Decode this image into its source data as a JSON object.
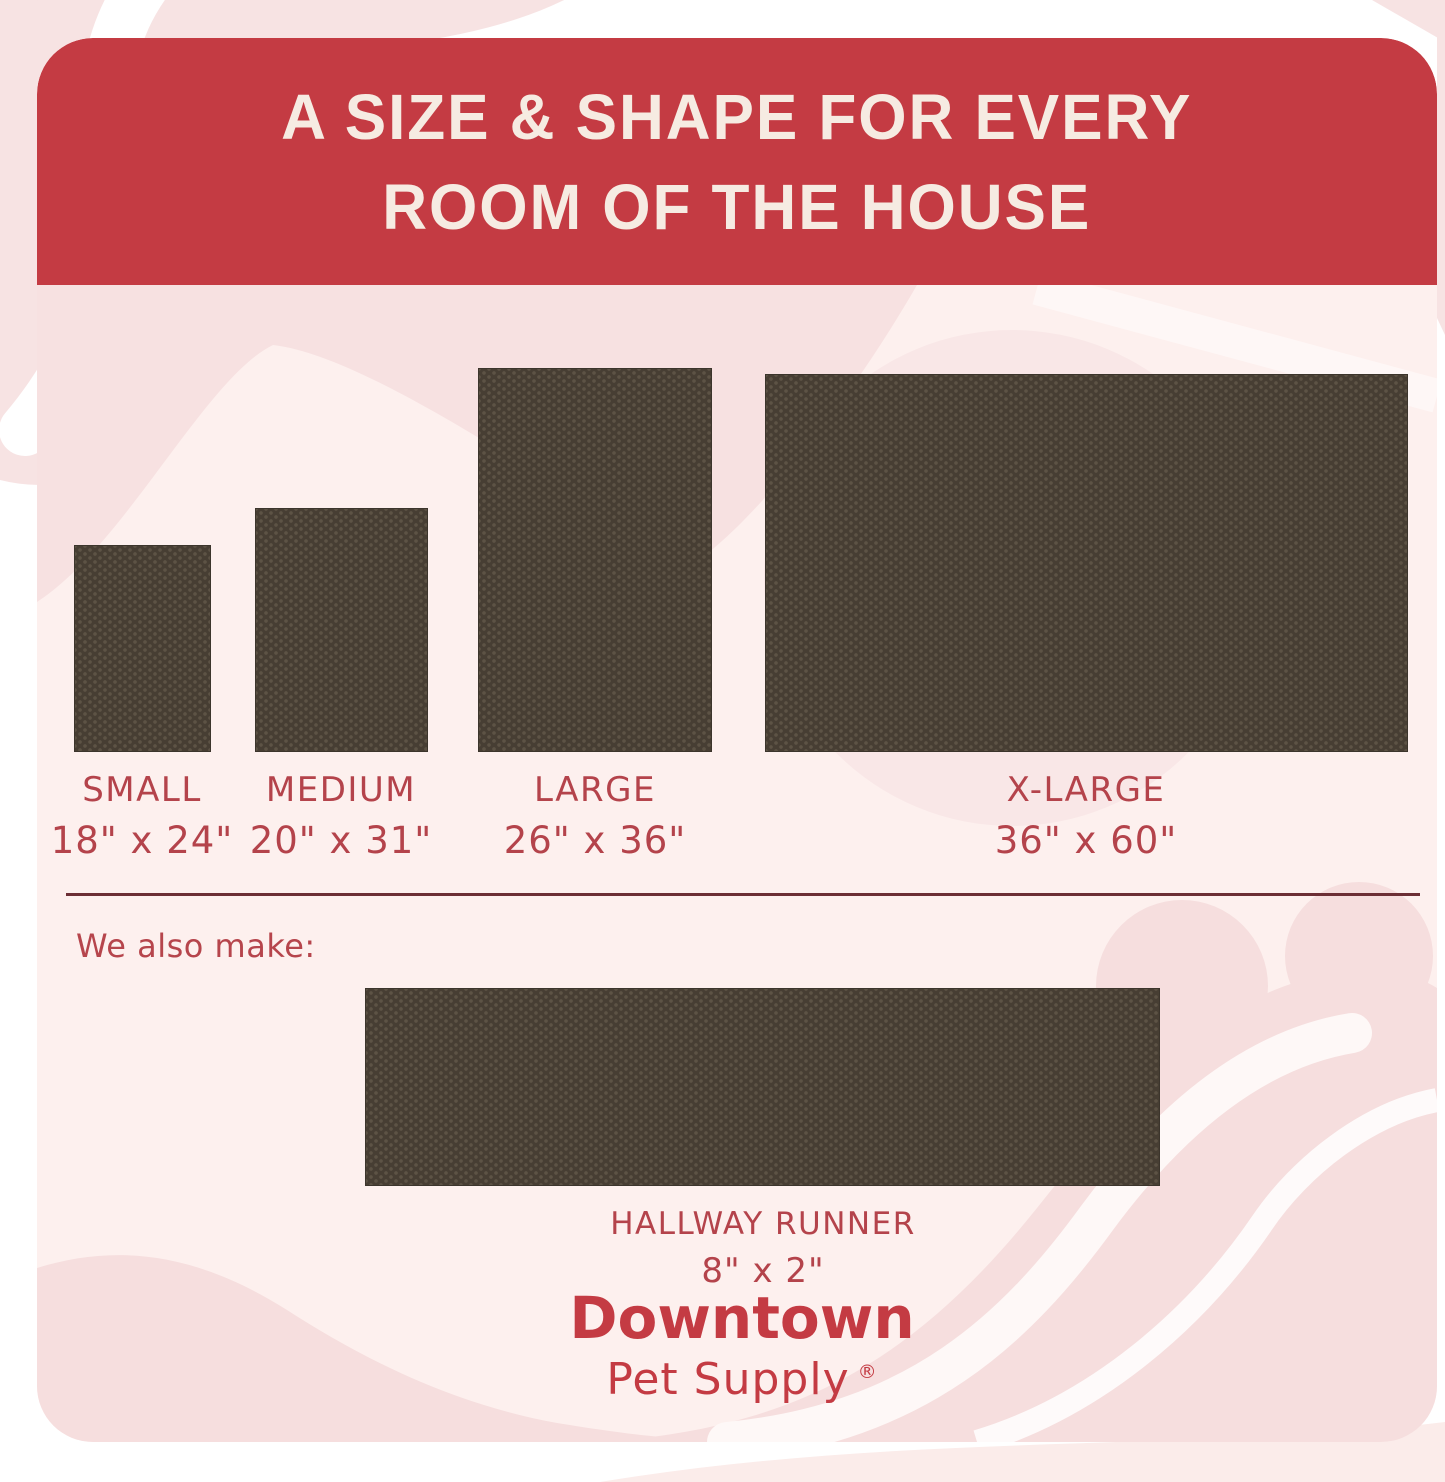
{
  "header": {
    "title_line1": "A SIZE & SHAPE FOR EVERY",
    "title_line2": "ROOM OF THE HOUSE"
  },
  "sizes": [
    {
      "name": "SMALL",
      "dimensions": "18\" x 24\""
    },
    {
      "name": "MEDIUM",
      "dimensions": "20\" x 31\""
    },
    {
      "name": "LARGE",
      "dimensions": "26\" x 36\""
    },
    {
      "name": "X-LARGE",
      "dimensions": "36\" x 60\""
    }
  ],
  "also_make": {
    "label": "We also make:"
  },
  "runner": {
    "name": "HALLWAY RUNNER",
    "dimensions": "8\" x 2\""
  },
  "brand": {
    "name": "Downtown",
    "subtitle": "Pet Supply",
    "registered_mark": "®"
  },
  "colors": {
    "header_red": "#c43b43",
    "header_text_cream": "#f6ebe2",
    "label_red": "#b4434b",
    "divider_maroon": "#6c2e35",
    "mat_brown": "#473e33",
    "mat_dot": "#5d5345",
    "card_pink": "#fdf0ee",
    "deco_pink": "#f6dede"
  }
}
